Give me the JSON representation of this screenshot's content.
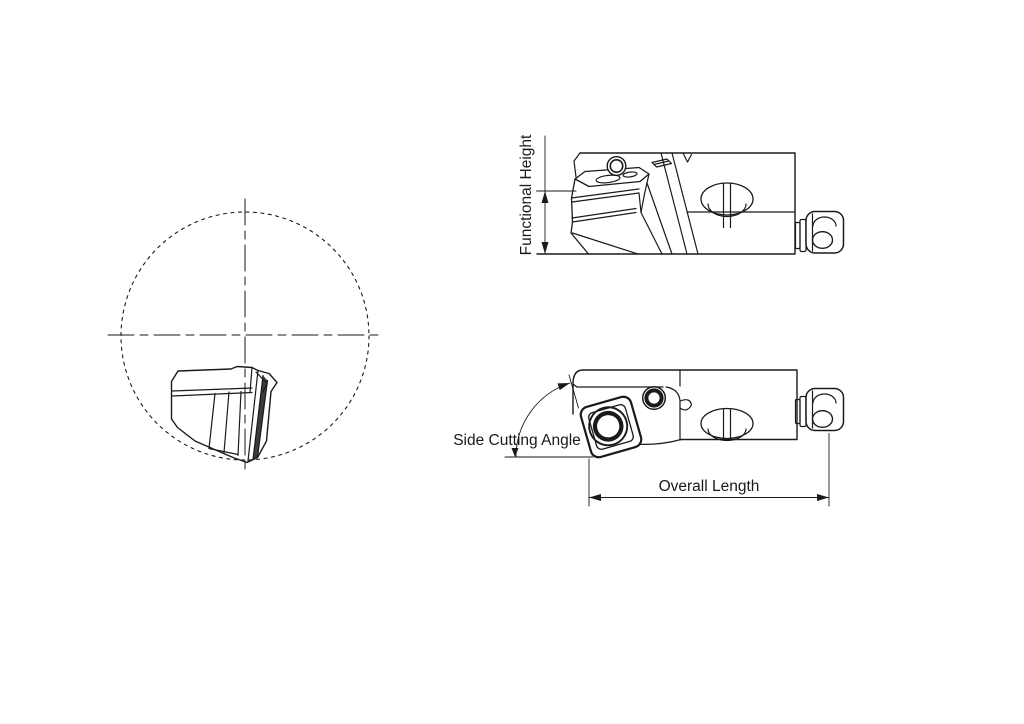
{
  "colors": {
    "background": "#ffffff",
    "line": "#1a1a1a"
  },
  "labels": {
    "functional_height": "Functional Height",
    "side_cutting_angle": "Side Cutting Angle",
    "overall_length": "Overall Length"
  },
  "views": {
    "end_view": "end-view-with-pitch-circle-and-centerlines",
    "side_view": "side-elevation-of-tool-holder",
    "plan_view": "plan-view-of-tool-holder"
  },
  "dimensions": [
    {
      "label": "Functional Height",
      "type": "linear-vertical"
    },
    {
      "label": "Side Cutting Angle",
      "type": "angular"
    },
    {
      "label": "Overall Length",
      "type": "linear-horizontal"
    }
  ]
}
